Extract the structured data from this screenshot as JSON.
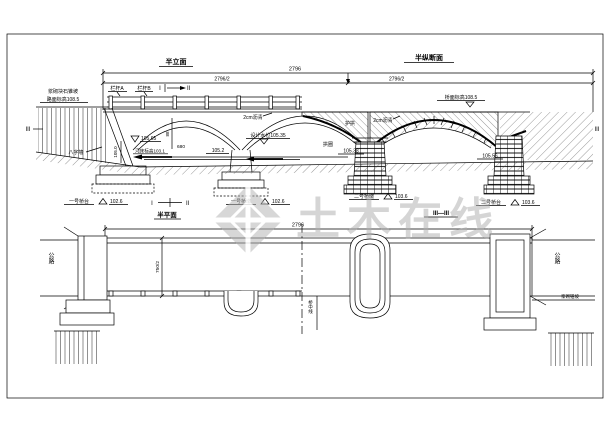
{
  "elevation": {
    "title_left": "半立面",
    "title_right": "半纵断面",
    "dims": {
      "total": "2796",
      "half_left": "2796/2",
      "half_right": "2796/2",
      "arch_span": "680",
      "arch_rise": "88",
      "wing_height": "105.0"
    },
    "labels": {
      "slope_protection": "浆砌块石锥坡",
      "road_elevation_left": "路面标高108.5",
      "deck_elevation_right": "桥面标高108.5",
      "railing_a": "栏杆A",
      "railing_b": "栏杆B",
      "asphalt_left": "2cm沥青",
      "asphalt_right": "2cm沥青",
      "flood_level": "105.65",
      "design_water_level": "设计水位105.35",
      "riverbed_elevation": "河床标高103.1",
      "water_elevation": "105.2",
      "arch_ring": "拱圈",
      "protective_arch": "护拱",
      "arch_elevation": "105.38",
      "springing_elevation": "105.56",
      "wing_wall": "八字墙"
    },
    "section_marks": {
      "s1": "I",
      "s2": "II",
      "s3_left": "III",
      "s3_right": "III"
    },
    "supports": [
      {
        "label": "一号桥台",
        "elevation": "102.6"
      },
      {
        "label": "一号桥墩",
        "elevation": "102.6"
      },
      {
        "label": "二号桥墩",
        "elevation": "103.6"
      },
      {
        "label": "二号桥台",
        "elevation": "103.6"
      }
    ]
  },
  "plan": {
    "title": "半平面",
    "section_title": "III—III",
    "dims": {
      "total": "2796",
      "half_width": "750/2"
    },
    "labels": {
      "road_left": "公路",
      "road_right": "公路",
      "centerline": "桥中线",
      "bank_note": "浆砌锥坡"
    },
    "marks": {
      "s1": "I",
      "s2": "II"
    }
  },
  "watermark": {
    "text": "土木在线",
    "color": "#b0b0b0"
  }
}
